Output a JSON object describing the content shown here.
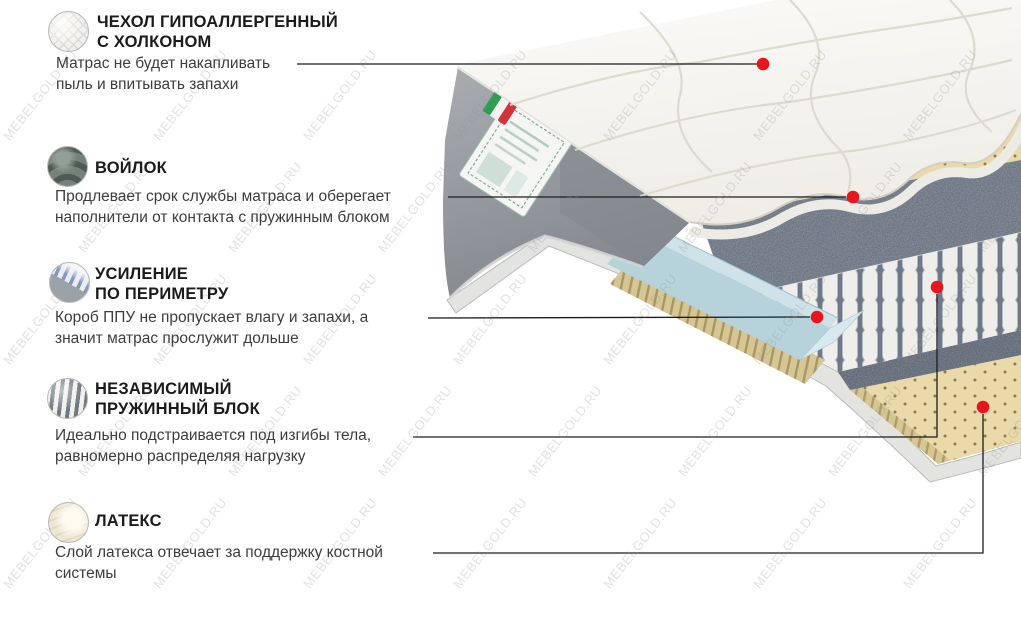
{
  "watermark": {
    "text": "MEBELGOLD.RU"
  },
  "colors": {
    "pointer_dot": "#e8151c",
    "leader_line": "#1c1c1c",
    "foam_box": "#b6d3dc",
    "latex_layer": "#ead9a9",
    "felt_layer": "#5d6674",
    "side_panel": "#9aa0a6"
  },
  "sections": [
    {
      "id": "cover",
      "icon": "quilt-icon",
      "title_lines": [
        "ЧЕХОЛ ГИПОАЛЛЕРГЕННЫЙ",
        "С ХОЛКОНОМ"
      ],
      "desc_lines": [
        "Матрас не будет накапливать",
        "пыль и впитывать запахи"
      ]
    },
    {
      "id": "felt",
      "icon": "felt-icon",
      "title_lines": [
        "ВОЙЛОК"
      ],
      "desc_lines": [
        "Продлевает срок службы матраса  и оберегает",
        "наполнители от контакта с пружинным блоком"
      ]
    },
    {
      "id": "perimeter",
      "icon": "perimeter-reinforcement-icon",
      "title_lines": [
        "УСИЛЕНИЕ",
        "ПО ПЕРИМЕТРУ"
      ],
      "desc_lines": [
        "Короб ППУ не пропускает влагу и запахи, а",
        "значит матрас прослужит дольше"
      ]
    },
    {
      "id": "springs",
      "icon": "pocket-springs-icon",
      "title_lines": [
        "НЕЗАВИСИМЫЙ",
        "ПРУЖИННЫЙ БЛОК"
      ],
      "desc_lines": [
        "Идеально подстраивается под изгибы тела,",
        "равномерно распределяя нагрузку"
      ]
    },
    {
      "id": "latex",
      "icon": "latex-icon",
      "title_lines": [
        "ЛАТЕКС"
      ],
      "desc_lines": [
        "Слой латекса отвечает за поддержку костной",
        "системы"
      ]
    }
  ]
}
